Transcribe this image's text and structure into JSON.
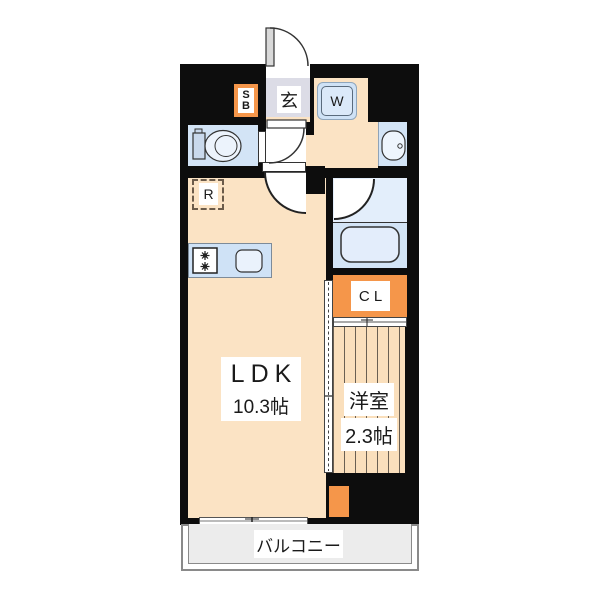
{
  "plan_type": "apartment-floor-plan",
  "labels": {
    "shoe_box": {
      "line1": "S",
      "line2": "B"
    },
    "entrance": "玄",
    "washer": "W",
    "refrigerator": "R",
    "closet": "C L",
    "ldk": {
      "name": "LDK",
      "size": "10.3帖"
    },
    "western_room": {
      "name": "洋室",
      "size": "2.3帖"
    },
    "balcony": "バルコニー"
  },
  "colors": {
    "wall": "#0d0d0d",
    "floor_peach": "#fbe3c4",
    "western_room_peach": "#fadfbc",
    "accent_orange": "#f5964a",
    "wet_area_blue": "#d3e4f6",
    "bath_light_blue": "#e3eefb",
    "counter_blue": "#cfe2f6",
    "entrance_gray": "#dcdce6",
    "balcony_gray": "#ececec",
    "stripe_line": "#6a5f52"
  },
  "icons": {
    "entrance_door": "swing-door-arc",
    "interior_doors": "swing-door-arc",
    "toilet": "toilet-top-view-icon",
    "washbasin": "oval-sink-icon",
    "bathtub": "rounded-tub-icon",
    "stove": "two-burner-stove-icon",
    "kitchen_sink": "rounded-sink-icon",
    "washer_pan": "washing-machine-pan-icon",
    "sliding_doors": "hatched-track",
    "balcony_window": "sliding-window-track"
  }
}
